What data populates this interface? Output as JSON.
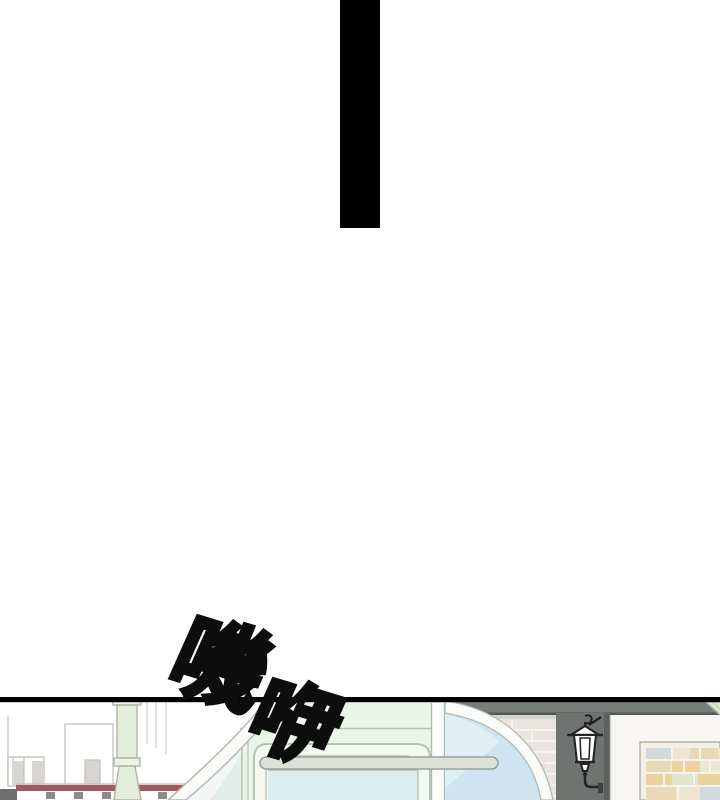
{
  "sfx": {
    "text": "嘰咿",
    "char1": "嘰",
    "char2": "咿",
    "style": "hand-drawn outlined sound effect, rotated diagonally",
    "fill": "#ffffff",
    "outline": "#0d0d0d"
  },
  "dividers": {
    "page_background": "#ffffff",
    "top_bar_color": "#000000",
    "panel_line_color": "#000000"
  },
  "scene": {
    "description": "top edge of storefront street illustration panel",
    "colors": {
      "mint_wall": "#ebf4e8",
      "glass_blue": "#cfe4f0",
      "glass_sheen": "#e3f0f8",
      "side_glass": "#e2edea",
      "arc_white": "#fbfbfa",
      "arc_edge": "#b2bab2",
      "door_line": "#b7c2b9",
      "door_fill": "#f3f8f1",
      "door_inner": "#fdfefd",
      "door_glass": "#dcedf0",
      "railing_fill": "#dce2da",
      "railing_line": "#97a299",
      "awning_gray": "#787d7a",
      "awning_edge": "#545855",
      "awning_light": "#d3d4d0",
      "brick_wall_light": "#eae5e1",
      "mortar_light": "#f6f3f0",
      "brick_pink": "#eedad5",
      "pillar_dark": "#6f7471",
      "pillar_dark_edge": "#5d615e",
      "wall_white": "#f7f6f3",
      "frame_bg": "#f3efe6",
      "frame_line": "#b5b2ac",
      "brick_cream": "#efe6d2",
      "brick_tan": "#e8d8b8",
      "brick_yellow": "#ead29e",
      "brick_bluegray": "#d2d8dc",
      "brick_green": "#e0e6d3",
      "roof_maroon": "#a25a5e",
      "outline_gray": "#c9c4be",
      "distant_gray": "#d7d5d1",
      "dark_block": "#6e6e6c",
      "tile_dark": "#8e8a86",
      "pole_green": "#e4edda",
      "pole_light": "#eef3e6",
      "pole_outline": "#a9b8a2",
      "wall_line": "#d6dbd3",
      "lamp_black": "#222222",
      "corner_green": "#dde8d3",
      "corner_line": "#a3ae9d"
    }
  }
}
